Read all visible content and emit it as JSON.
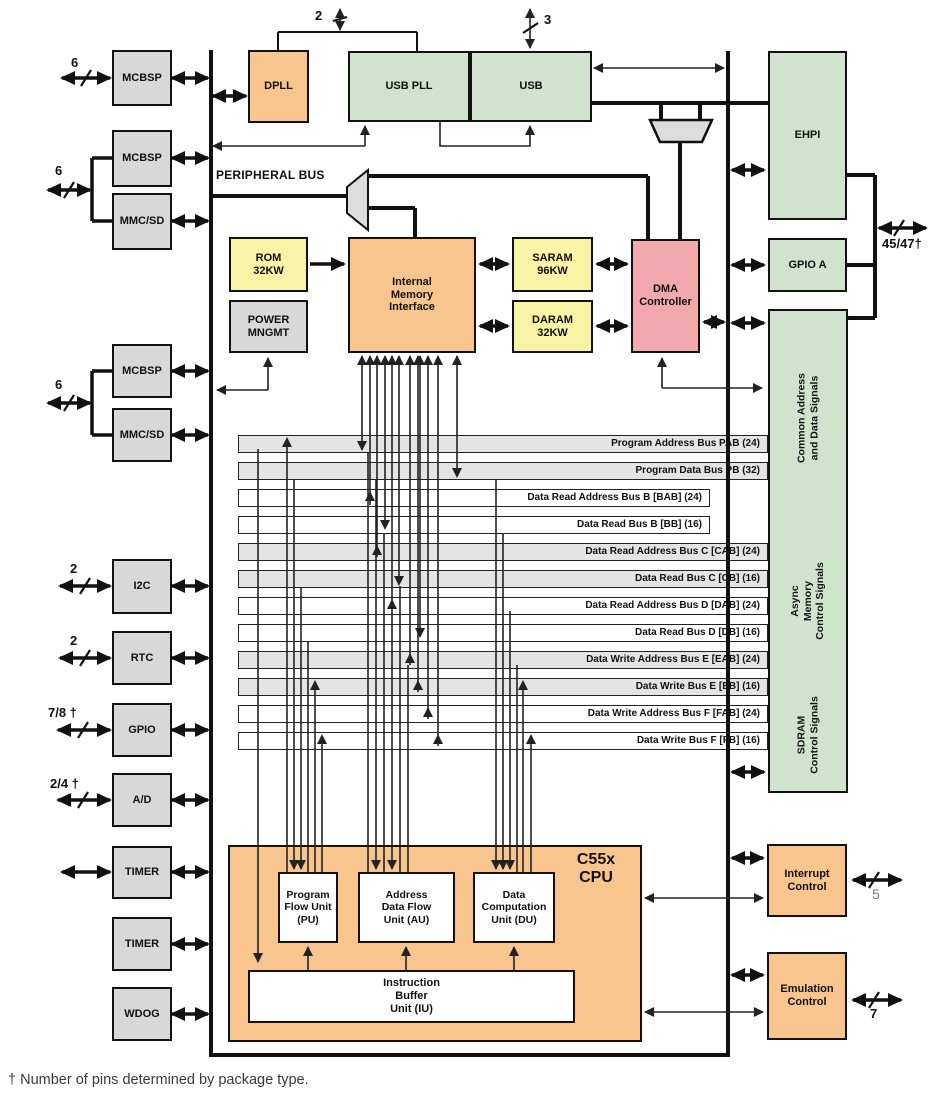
{
  "peripheral_bus": "PERIPHERAL BUS",
  "footnote": "† Number of pins determined by package type.",
  "left_blocks": [
    "MCBSP",
    "MCBSP",
    "MMC/SD",
    "MCBSP",
    "MMC/SD",
    "I2C",
    "RTC",
    "GPIO",
    "A/D",
    "TIMER",
    "TIMER",
    "WDOG"
  ],
  "pins": {
    "mcbsp1": "6",
    "group1": "6",
    "group2": "6",
    "i2c": "2",
    "rtc": "2",
    "gpio": "7/8 †",
    "ad": "2/4 †",
    "pll": "2",
    "usb": "3",
    "ehpi_gpioa": "45/47†",
    "interrupt": "5",
    "emulation": "7"
  },
  "top": {
    "dpll": "DPLL",
    "usb_pll": "USB PLL",
    "usb": "USB"
  },
  "memory": {
    "rom": "ROM\n32KW",
    "power_mngmt": "POWER\nMNGMT",
    "internal_memory_interface": "Internal\nMemory\nInterface",
    "saram": "SARAM\n96KW",
    "daram": "DARAM\n32KW",
    "dma": "DMA\nController"
  },
  "right": {
    "ehpi": "EHPI",
    "gpio_a": "GPIO A",
    "signal_sections": [
      "Common Address\nand Data Signals",
      "Async\nMemory\nControl Signals",
      "SDRAM\nControl Signals"
    ],
    "interrupt": "Interrupt\nControl",
    "emulation": "Emulation\nControl"
  },
  "buses": [
    "Program Address Bus PAB (24)",
    "Program Data Bus PB (32)",
    "Data Read Address Bus B [BAB] (24)",
    "Data Read Bus B [BB] (16)",
    "Data Read Address Bus C [CAB] (24)",
    "Data Read Bus C [CB] (16)",
    "Data Read Address Bus D [DAB] (24)",
    "Data Read Bus D [DB] (16)",
    "Data Write Address Bus E [EAB] (24)",
    "Data Write Bus E [EB] (16)",
    "Data Write Address Bus F [FAB] (24)",
    "Data Write Bus F [FB] (16)"
  ],
  "cpu": {
    "title": "C55x\nCPU",
    "pu": "Program\nFlow Unit\n(PU)",
    "au": "Address\nData Flow\nUnit (AU)",
    "du": "Data\nComputation\nUnit (DU)",
    "iu": "Instruction\nBuffer\nUnit (IU)"
  },
  "colors": {
    "orange": "#f7c58d",
    "green": "#cfe3cd",
    "yellow": "#f9f3a6",
    "pink": "#f2a9ae",
    "gray": "#d8d8d8",
    "bar_gray": "#e4e4e4"
  }
}
